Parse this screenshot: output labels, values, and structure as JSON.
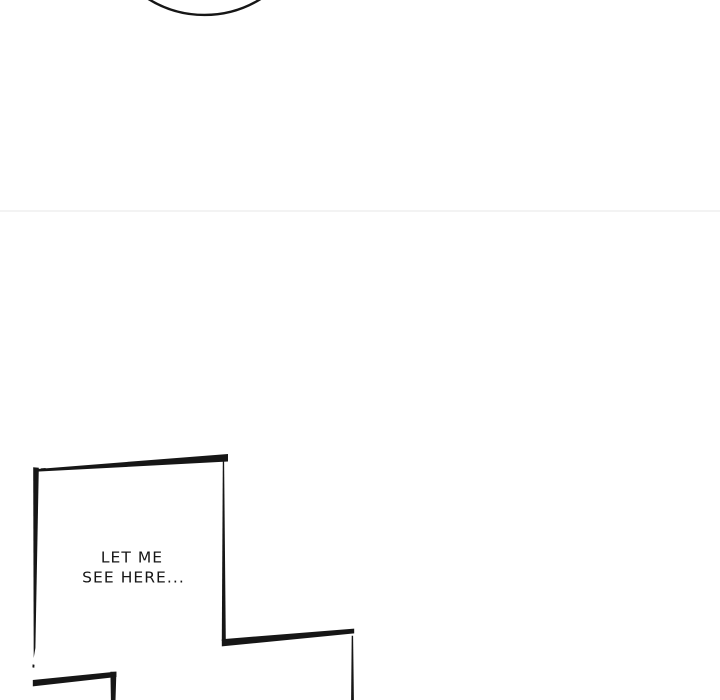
{
  "page": {
    "background_color": "#ffffff",
    "ink_color": "#161616",
    "seam_divider_color": "#f0f0f0"
  },
  "panel": {
    "dialogue_line1": "LET ME",
    "dialogue_line2": "SEE HERE..."
  }
}
